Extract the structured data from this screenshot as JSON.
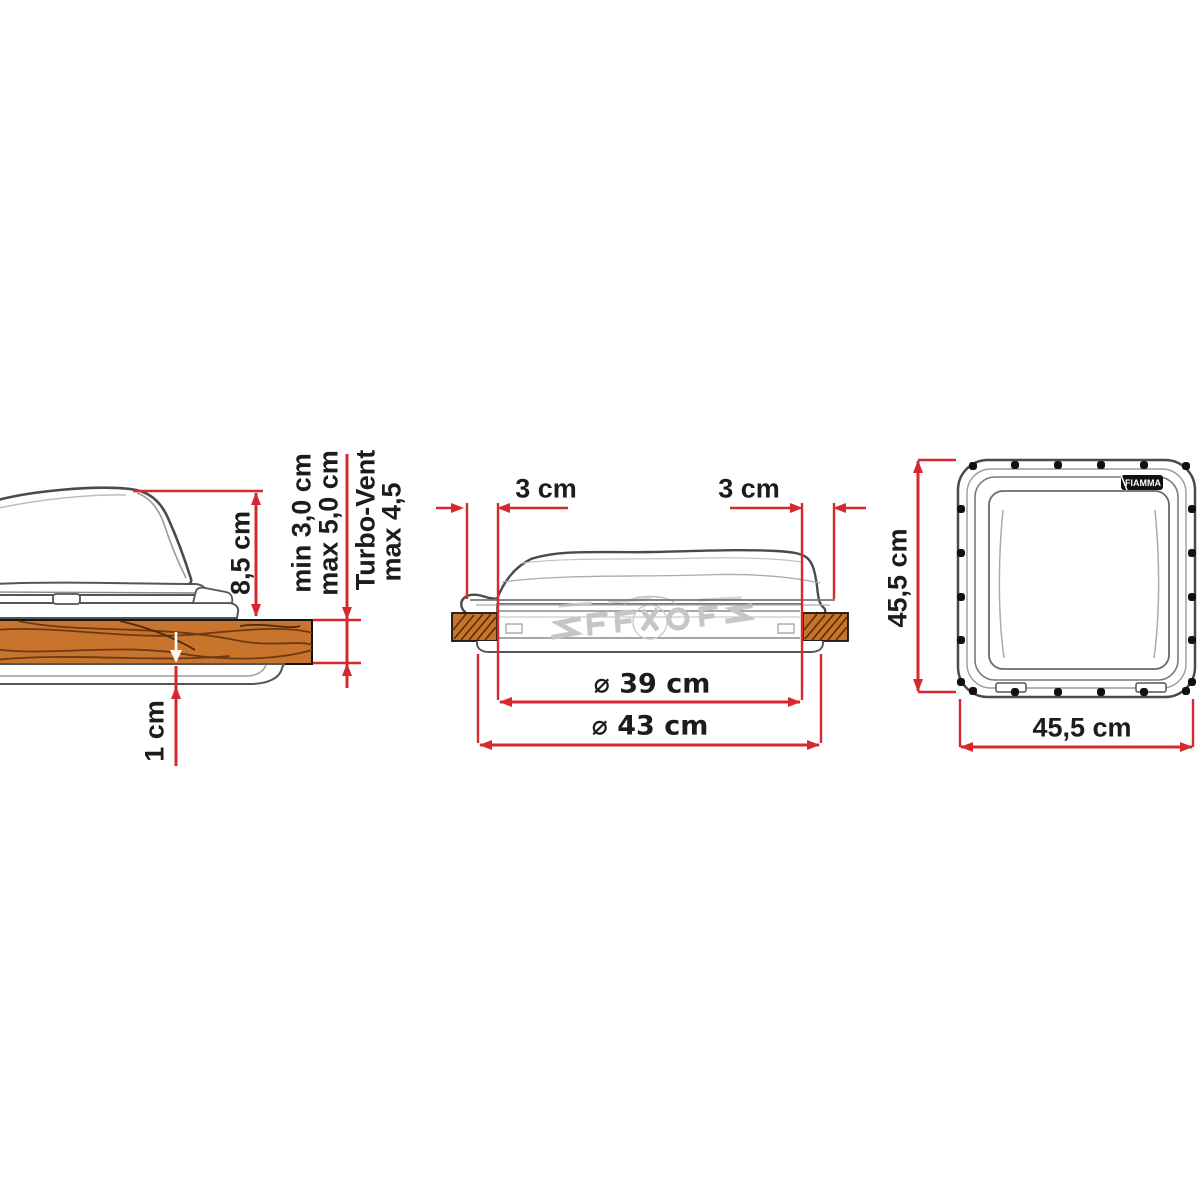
{
  "title": "Roof vent installation dimensions diagram",
  "colors": {
    "dimension_red": "#d7282f",
    "wood_fill": "#c9742c",
    "wood_grain": "#6b3a12",
    "line_dark": "#464646",
    "text": "#1c1c1c"
  },
  "views": {
    "side_section": {
      "labels": {
        "lid_height": "8,5 cm",
        "roof_thickness_min": "min 3,0 cm",
        "roof_thickness_max": "max 5,0 cm",
        "turbo_vent": "Turbo-Vent",
        "turbo_vent_max": "max 4,5",
        "inner_frame_gap": "1 cm"
      }
    },
    "front_section": {
      "labels": {
        "overlap_left": "3 cm",
        "overlap_right": "3 cm",
        "opening_diameter": "⌀ 39 cm",
        "outer_diameter": "⌀ 43 cm"
      }
    },
    "top_view": {
      "labels": {
        "side_height": "45,5 cm",
        "side_width": "45,5 cm",
        "logo": "FIAMMA"
      }
    }
  }
}
